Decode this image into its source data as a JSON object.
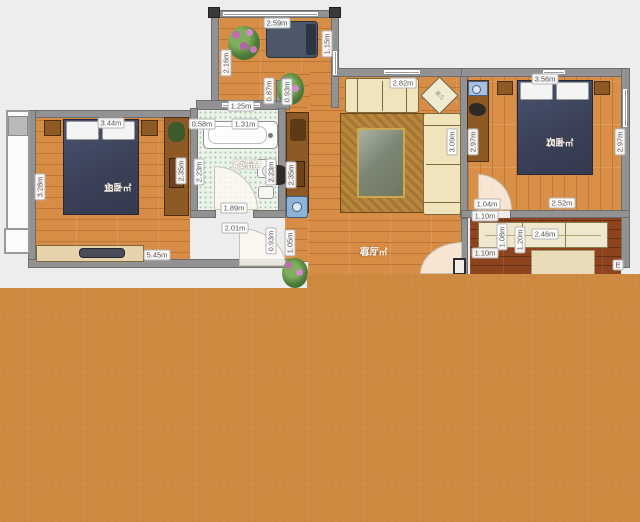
{
  "plan": {
    "title": "apartment-floor-plan",
    "rooms": [
      {
        "id": "master-bedroom",
        "name": "主卧",
        "area": "13.2 ㎡",
        "x": 104,
        "y": 183
      },
      {
        "id": "washroom",
        "name": "盥洗室",
        "area": "4.2 ㎡",
        "x": 233,
        "y": 160
      },
      {
        "id": "living-room",
        "name": "客厅",
        "area": "41.9 ㎡",
        "x": 360,
        "y": 247
      },
      {
        "id": "second-bedroom",
        "name": "次卧",
        "area": "10.6 ㎡",
        "x": 546,
        "y": 138
      }
    ],
    "dimensions": [
      {
        "text": "2.59m",
        "x": 277,
        "y": 23,
        "v": false
      },
      {
        "text": "1.15m",
        "x": 327,
        "y": 44,
        "v": true
      },
      {
        "text": "2.16m",
        "x": 226,
        "y": 63,
        "v": true
      },
      {
        "text": "0.87m",
        "x": 269,
        "y": 91,
        "v": true
      },
      {
        "text": "0.93m",
        "x": 287,
        "y": 92,
        "v": true
      },
      {
        "text": "1.25m",
        "x": 241,
        "y": 106,
        "v": false
      },
      {
        "text": "0.58m",
        "x": 202,
        "y": 124,
        "v": false
      },
      {
        "text": "1.31m",
        "x": 245,
        "y": 124,
        "v": false
      },
      {
        "text": "2.23m",
        "x": 199,
        "y": 172,
        "v": true
      },
      {
        "text": "2.23m",
        "x": 271,
        "y": 172,
        "v": true
      },
      {
        "text": "1.89m",
        "x": 234,
        "y": 208,
        "v": false
      },
      {
        "text": "3.44m",
        "x": 111,
        "y": 123,
        "v": false
      },
      {
        "text": "3.28m",
        "x": 40,
        "y": 187,
        "v": true
      },
      {
        "text": "2.35m",
        "x": 181,
        "y": 171,
        "v": true
      },
      {
        "text": "5.45m",
        "x": 157,
        "y": 255,
        "v": false
      },
      {
        "text": "2.35m",
        "x": 291,
        "y": 175,
        "v": true
      },
      {
        "text": "2.01m",
        "x": 235,
        "y": 228,
        "v": false
      },
      {
        "text": "0.93m",
        "x": 271,
        "y": 241,
        "v": true
      },
      {
        "text": "1.05m",
        "x": 290,
        "y": 243,
        "v": true
      },
      {
        "text": "2.82m",
        "x": 403,
        "y": 83,
        "v": false
      },
      {
        "text": "3.09m",
        "x": 452,
        "y": 142,
        "v": true
      },
      {
        "text": "3.56m",
        "x": 545,
        "y": 79,
        "v": false
      },
      {
        "text": "2.97m",
        "x": 473,
        "y": 142,
        "v": true
      },
      {
        "text": "2.97m",
        "x": 620,
        "y": 142,
        "v": true
      },
      {
        "text": "1.04m",
        "x": 487,
        "y": 204,
        "v": false
      },
      {
        "text": "2.52m",
        "x": 562,
        "y": 203,
        "v": false
      },
      {
        "text": "1.10m",
        "x": 485,
        "y": 216,
        "v": false
      },
      {
        "text": "1.08m",
        "x": 502,
        "y": 237,
        "v": true
      },
      {
        "text": "1.10m",
        "x": 485,
        "y": 253,
        "v": false
      },
      {
        "text": "1.20m",
        "x": 520,
        "y": 240,
        "v": true
      },
      {
        "text": "2.46m",
        "x": 545,
        "y": 234,
        "v": false
      },
      {
        "text": "E",
        "x": 618,
        "y": 265,
        "v": false
      }
    ],
    "furniture": {
      "tea_table_label": "茶几"
    },
    "overlay_color": "#cf8a41"
  }
}
